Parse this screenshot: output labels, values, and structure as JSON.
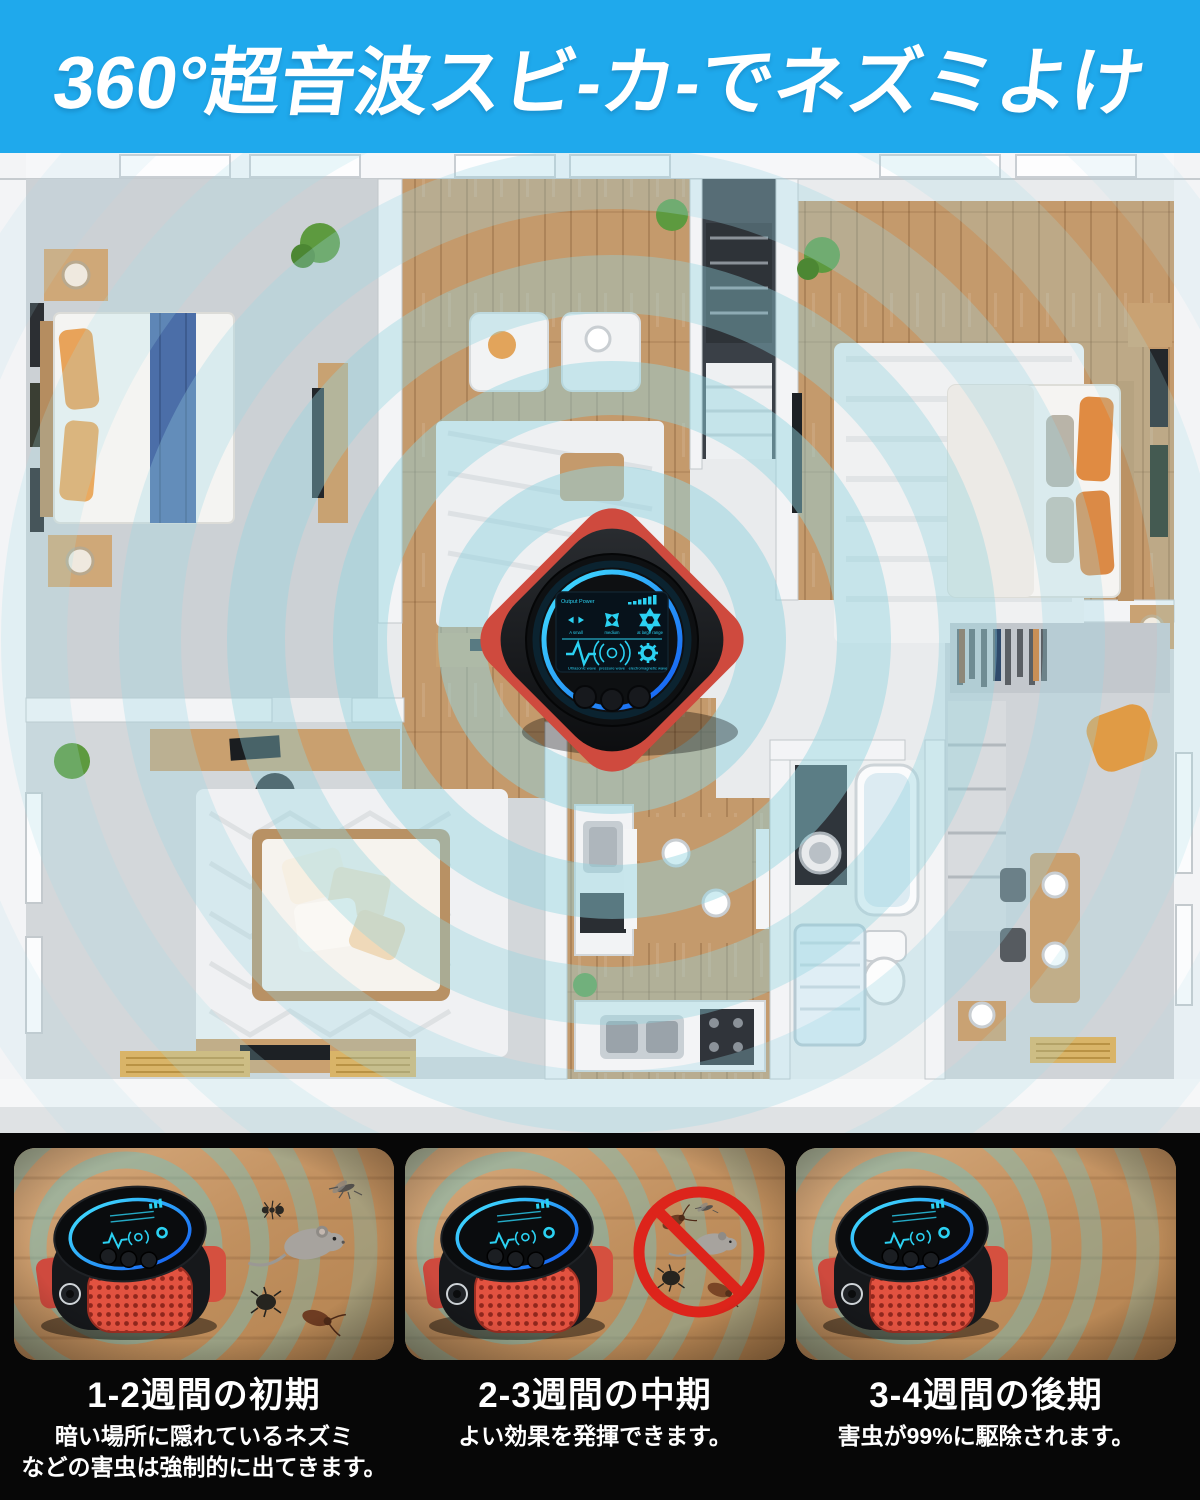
{
  "header": {
    "title": "360°超音波スビ-カ-でネズミよけ",
    "bg_color": "#1fa9ec",
    "text_color": "#ffffff"
  },
  "palette": {
    "wave_teal": "#8fd2de",
    "panel_wave_teal": "#6fc3c3",
    "device_red": "#d5503f",
    "screen_cyan": "#2bd1f2",
    "stage_section_bg": "#070707",
    "wood": "#c49a6c"
  },
  "device_screen": {
    "power_label": "Output Power",
    "range_modes": [
      {
        "label": "A small"
      },
      {
        "label": "medium"
      },
      {
        "label": "at large range"
      }
    ],
    "wave_types": [
      {
        "label": "Ultrasonic wave"
      },
      {
        "label": "pressure wave"
      },
      {
        "label": "electromagnetic wave"
      }
    ]
  },
  "stages": [
    {
      "title": "1-2週間の初期",
      "description": "暗い場所に隠れているネズミ\nなどの害虫は強制的に出てきます。"
    },
    {
      "title": "2-3週間の中期",
      "description": "よい効果を発揮できます。"
    },
    {
      "title": "3-4週間の後期",
      "description": "害虫が99%に駆除されます。"
    }
  ]
}
